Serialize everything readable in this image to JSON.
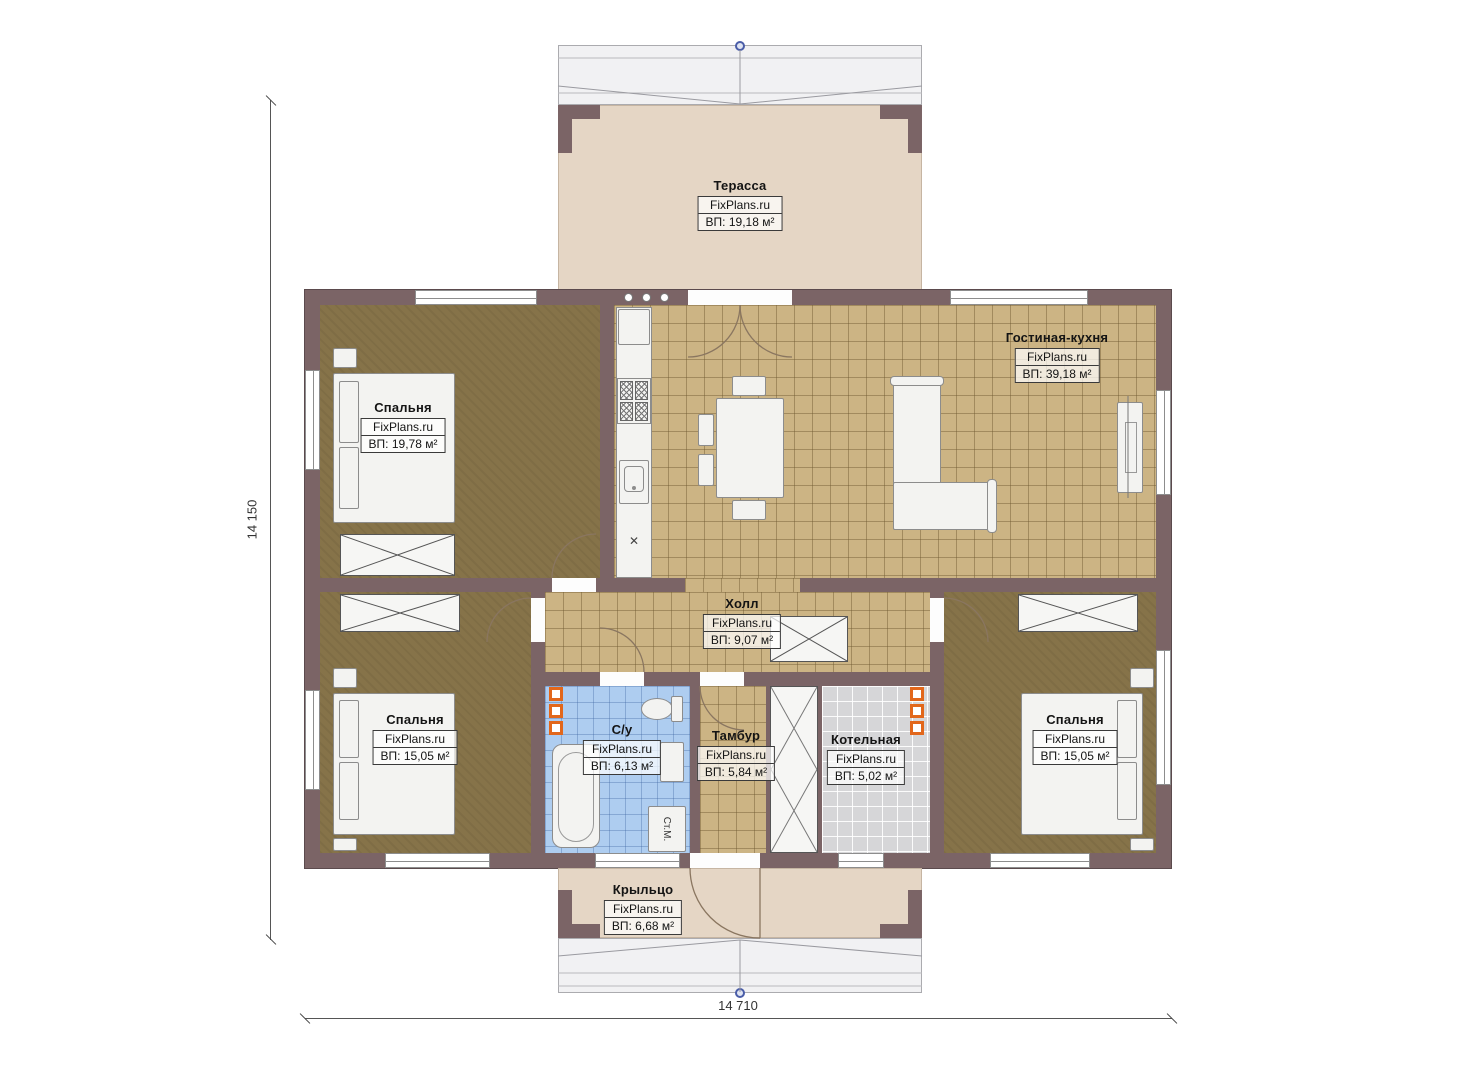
{
  "plan": {
    "site": "FixPlans.ru",
    "rooms": {
      "terrace": {
        "name": "Терасса",
        "watermark": "FixPlans.ru",
        "area": "ВП: 19,18 м²"
      },
      "living": {
        "name": "Гостиная-кухня",
        "watermark": "FixPlans.ru",
        "area": "ВП: 39,18 м²"
      },
      "bedroom1": {
        "name": "Спальня",
        "watermark": "FixPlans.ru",
        "area": "ВП: 19,78 м²"
      },
      "hall": {
        "name": "Холл",
        "watermark": "FixPlans.ru",
        "area": "ВП: 9,07 м²"
      },
      "bedroom2": {
        "name": "Спальня",
        "watermark": "FixPlans.ru",
        "area": "ВП: 15,05 м²"
      },
      "bathroom": {
        "name": "С/у",
        "watermark": "FixPlans.ru",
        "area": "ВП: 6,13 м²"
      },
      "vestibule": {
        "name": "Тамбур",
        "watermark": "FixPlans.ru",
        "area": "ВП: 5,84 м²"
      },
      "boiler": {
        "name": "Котельная",
        "watermark": "FixPlans.ru",
        "area": "ВП: 5,02 м²"
      },
      "bedroom3": {
        "name": "Спальня",
        "watermark": "FixPlans.ru",
        "area": "ВП: 15,05 м²"
      },
      "porch": {
        "name": "Крыльцо",
        "watermark": "FixPlans.ru",
        "area": "ВП: 6,68 м²"
      }
    },
    "dimensions": {
      "vertical": "14 150",
      "horizontal": "14 710"
    },
    "appliances": {
      "washing_machine": "Ст.М."
    },
    "colors": {
      "wall": "#7b6466",
      "floor_tile_tan": "#ccb484",
      "floor_bedroom": "#867349",
      "floor_bathroom": "#aecdf0",
      "floor_boiler": "#d6d6d8",
      "terrace_deck": "#e5d6c5",
      "radiator_orange": "#e2671b",
      "axis_marker_blue": "#4a5da8"
    }
  }
}
